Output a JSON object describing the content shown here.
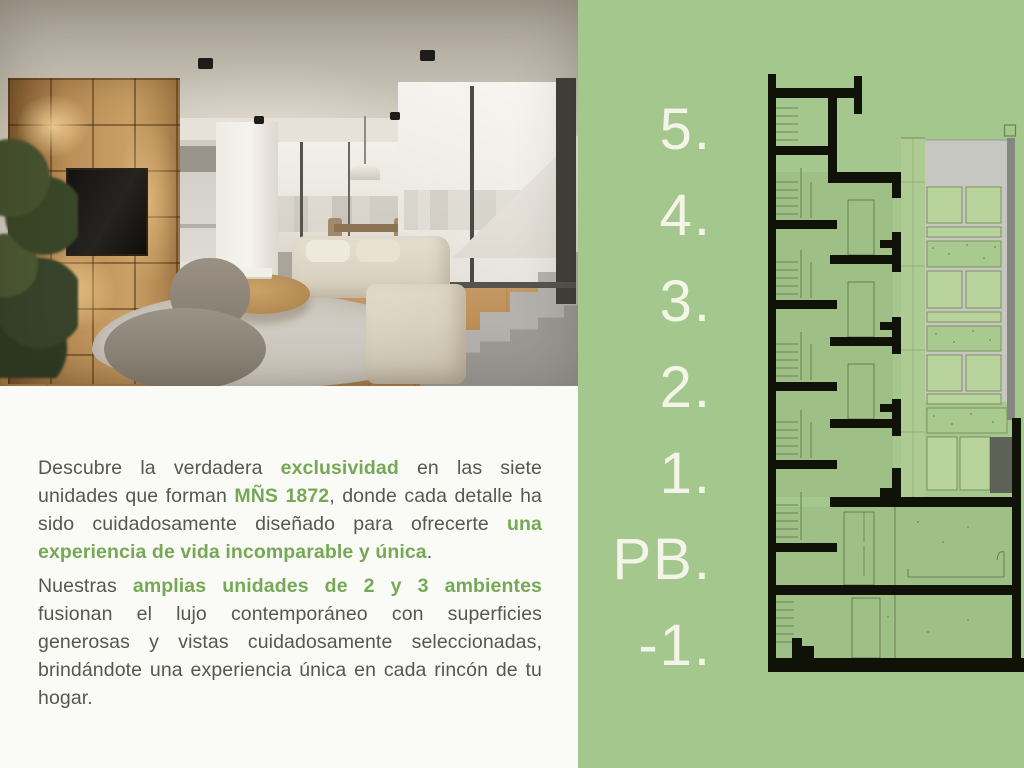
{
  "text_panel": {
    "p1": {
      "s1": "Descubre la verdadera ",
      "s2": "exclusividad",
      "s3": " en las siete unidades que forman ",
      "s4": "MÑS 1872",
      "s5": ", donde cada detalle ha sido cuidadosamente diseñado para ofrecerte ",
      "s6": "una experiencia de vida incomparable y única",
      "s7": "."
    },
    "p2": {
      "s1": "Nuestras ",
      "s2": "amplias unidades de 2 y 3 ambientes",
      "s3": " fusionan el lujo contemporáneo con superficies generosas y vistas cuidadosamente seleccionadas, brindándote una experiencia única en cada rincón de tu hogar."
    }
  },
  "floor_labels": {
    "f5": "5.",
    "f4": "4.",
    "f3": "3.",
    "f2": "2.",
    "f1": "1.",
    "pb": "PB.",
    "m1": "-1."
  },
  "colors": {
    "panel_green": "#a3c78d",
    "accent_green": "#76a955",
    "body_text": "#54584e",
    "label_cream": "#f4f5e8",
    "drawing_black": "#101208",
    "drawing_olive": "#5c6b47",
    "elevation_gray": "#c6c7c1",
    "panel_light_green": "#b9d39d"
  }
}
